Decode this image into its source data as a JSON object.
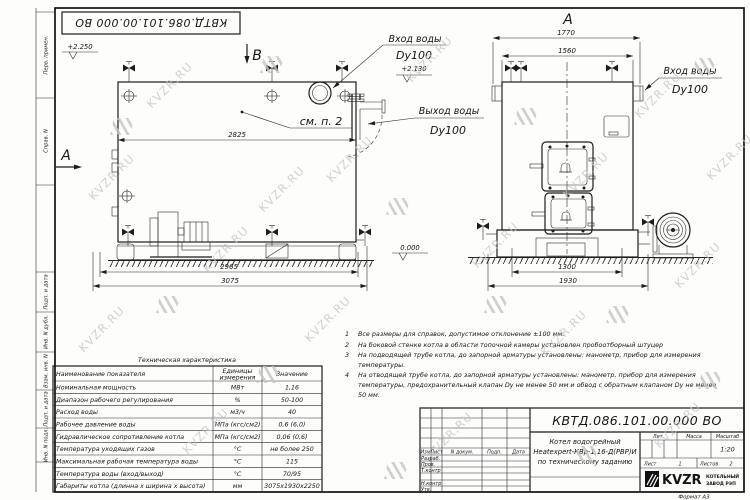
{
  "sheet": {
    "stamp": "КВТД.086.101.00.000  ВО",
    "format_label": "Формат  А3",
    "frame_labels": [
      "Перв. примен.",
      "Справ. N",
      "Подп. и дата",
      "Инв. N дубл.",
      "Взам. инв. N",
      "Подп. и дата",
      "Инв. N подл."
    ]
  },
  "watermark": {
    "text": "KVZR.RU"
  },
  "side_view": {
    "label_b": "В",
    "label_a": "А",
    "see_note": "см. п. 2",
    "elev_top": "+2.250",
    "elev_inlet": "+2.130",
    "elev_zero": "0.000",
    "inlet_label": "Вход воды",
    "inlet_dn": "Dy100",
    "outlet_label": "Выход воды",
    "outlet_dn": "Dy100",
    "dim_body": "2825",
    "dim_frame": "2965",
    "dim_overall": "3075"
  },
  "front_view": {
    "label": "А",
    "dim_overall_top": "1770",
    "dim_body_top": "1560",
    "dim_base": "1300",
    "dim_overall_bottom": "1930",
    "inlet_label": "Вход воды",
    "inlet_dn": "Dy100"
  },
  "notes": {
    "items": [
      {
        "num": "1",
        "text": "Все размеры для справок, допустимое отклонение ±100 мм."
      },
      {
        "num": "2",
        "text": "На боковой стенке котла в области топочной камеры установлен пробоотборный штуцер"
      },
      {
        "num": "3",
        "text": "На подводящей трубе котла, до запорной арматуры установлены: манометр, прибор для измерения температуры."
      },
      {
        "num": "4",
        "text": "На отводящей трубе котла, до запорной арматуры установлены: манометр, прибор для измерения температуры, предохранительный клапан Dу не менее 50 мм и обвод с обратным клапаном Dу не менее 50 мм."
      }
    ]
  },
  "spec_table": {
    "title": "Техническая характеристика",
    "headers": [
      "Наименование показателя",
      "Единицы",
      "измерения",
      "Значение"
    ],
    "rows": [
      [
        "Номинальная мощность",
        "МВт",
        "1,16"
      ],
      [
        "Диапазон рабочего регулирования",
        "%",
        "50-100"
      ],
      [
        "Расход воды",
        "м3/ч",
        "40"
      ],
      [
        "Рабочее давление воды",
        "МПа (кгс/см2)",
        "0,6 (6,0)"
      ],
      [
        "Гидравлическое сопротивление котла",
        "МПа (кгс/см2)",
        "0,06 (0,6)"
      ],
      [
        "Температура уходящих газов",
        "°С",
        "не более 250"
      ],
      [
        "Максимальная рабочая температура воды",
        "°С",
        "115"
      ],
      [
        "Температура воды (вход/выход)",
        "°С",
        "70/95"
      ],
      [
        "Габариты котла (длинна х ширина х высота)",
        "мм",
        "3075х1930х2250"
      ]
    ]
  },
  "title_block": {
    "designation": "КВТД.086.101.00.000  ВО",
    "header_cells": [
      "Изм",
      "Лист",
      "N докум.",
      "Подп.",
      "Дата"
    ],
    "rows": [
      "Разраб.",
      "Пров.",
      "Т.контр",
      "Н.контр",
      "Утв."
    ],
    "name_line1": "Котел водогрейный",
    "name_line2": "Heatexpert-КВр-1,16-Д(РВР)И",
    "name_line3": "по техническому заданию",
    "lit_label": "Лит.",
    "mass_label": "Масса",
    "scale_label": "Масштаб",
    "scale_value": "1:20",
    "sheet_label": "Лист",
    "sheet_value": "1",
    "sheets_label": "Листов",
    "sheets_value": "2",
    "company_logo": "KVZR",
    "company_name1": "КОТЕЛЬНЫЙ",
    "company_name2": "ЗАВОД РЭП"
  }
}
